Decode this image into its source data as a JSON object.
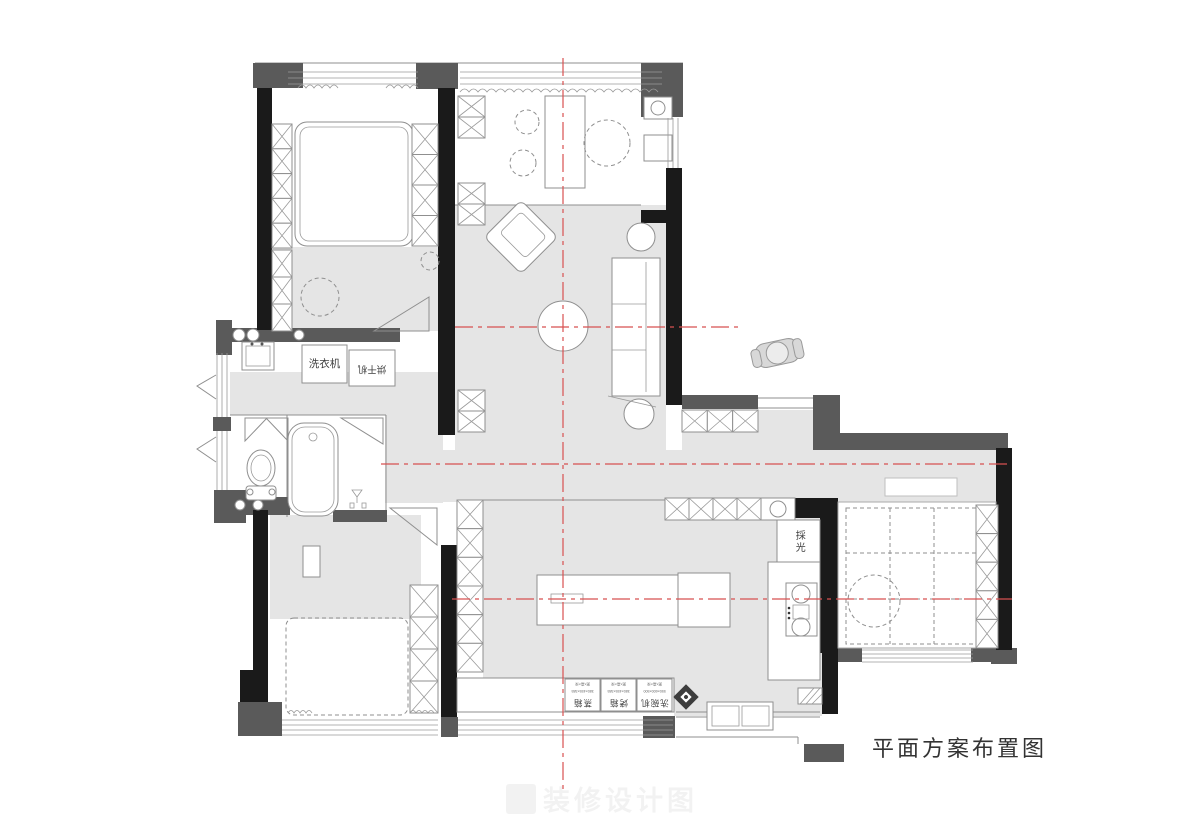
{
  "title": "平面方案布置图",
  "watermark": "装修设计图",
  "labels": {
    "washer": "洗衣机",
    "dryer": "烘干机",
    "skylight": "採光",
    "appliances": [
      {
        "name": "蒸箱",
        "size": "380×455×385",
        "note": "宽×高×深"
      },
      {
        "name": "烤箱",
        "size": "380×455×385",
        "note": "宽×高×深"
      },
      {
        "name": "洗碗机",
        "size": "550×600×500",
        "note": "宽×高×深"
      }
    ]
  },
  "colors": {
    "wall": "#1a1a1a",
    "wall_secondary": "#5a5a5a",
    "floor": "#e5e5e5",
    "axis_red": "#d85050",
    "outline": "#8f8f8f"
  }
}
